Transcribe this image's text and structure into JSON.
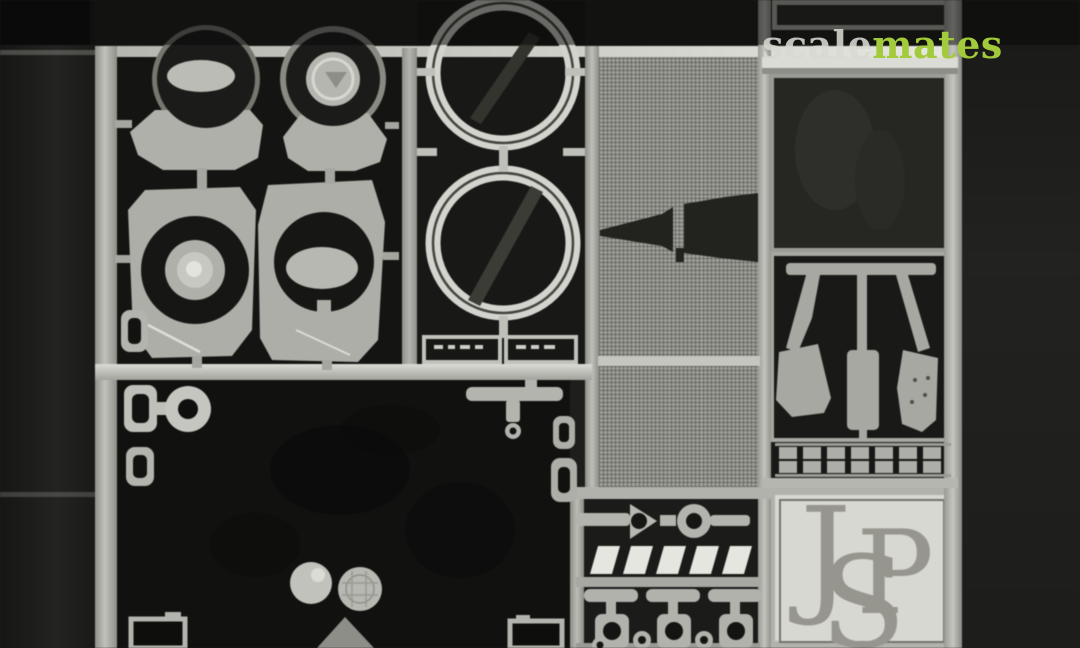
{
  "description": "Photograph of a photo-etched metal detail fret (scale model accessory) on a dark background",
  "watermark": {
    "scale": "scale",
    "mates": "mates",
    "scale_color": "#d8d8d2",
    "mates_color": "#a3ca3b"
  },
  "logo_plate": {
    "letters": [
      "J",
      "S",
      "P"
    ],
    "letter_color": "#96968e",
    "plate_color": "#d8d8d2"
  },
  "colors": {
    "background": "#1e1e1c",
    "metal": "#b2b2ac",
    "metal_bright": "#d8d8d2",
    "etch_dark": "#141412",
    "mesh_base": "#a0a09a"
  },
  "parts": [
    "headlight-bucket-with-ellipse",
    "headlight-bucket-with-disc",
    "reflector-bucket-concentric",
    "reflector-bucket-ellipse",
    "bezel-ring-upper",
    "bezel-ring-lower",
    "etched-label-plates",
    "mesh-grille-panel",
    "tapered-wedge-part",
    "pedal-set-three",
    "tread-plate-strips",
    "louver-slats",
    "t-bracket-fittings",
    "keyhole-ring-parts",
    "small-discs",
    "corner-brackets",
    "monogram-logo-plate"
  ]
}
